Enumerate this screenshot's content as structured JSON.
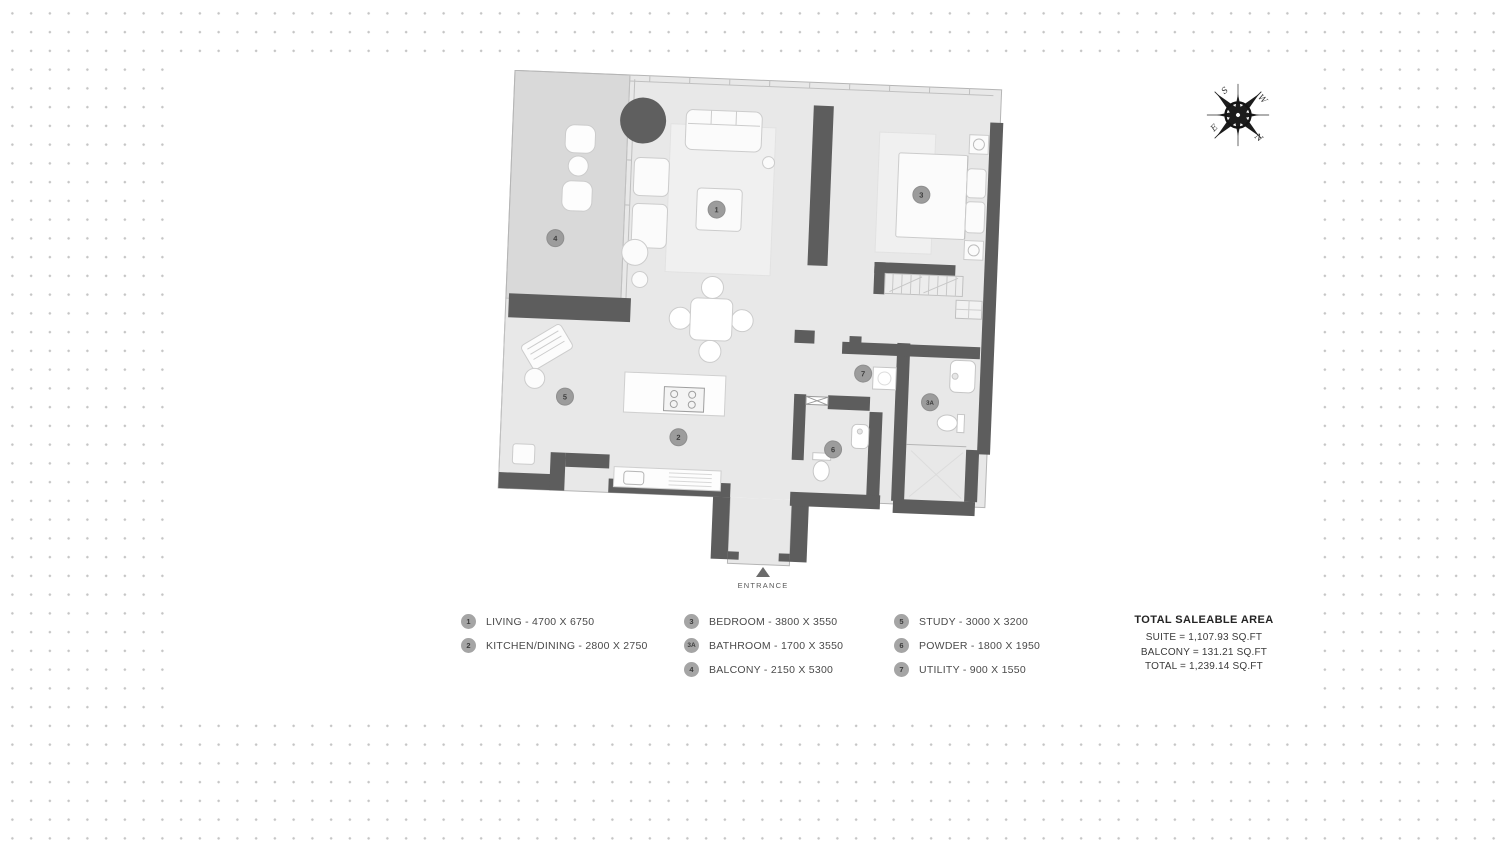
{
  "plan": {
    "entrance_label": "ENTRANCE",
    "badges": {
      "living": "1",
      "kitchen_dining": "2",
      "bedroom": "3",
      "bathroom": "3A",
      "balcony": "4",
      "study": "5",
      "powder": "6",
      "utility": "7"
    }
  },
  "compass": {
    "n": "N",
    "e": "E",
    "s": "S",
    "w": "W"
  },
  "legend": {
    "items": [
      {
        "num": "1",
        "label": "LIVING - 4700 X 6750"
      },
      {
        "num": "2",
        "label": "KITCHEN/DINING - 2800 X 2750"
      },
      {
        "num": "3",
        "label": "BEDROOM - 3800 X 3550"
      },
      {
        "num": "3A",
        "label": "BATHROOM - 1700 X 3550"
      },
      {
        "num": "4",
        "label": "BALCONY - 2150 X 5300"
      },
      {
        "num": "5",
        "label": "STUDY - 3000 X 3200"
      },
      {
        "num": "6",
        "label": "POWDER - 1800 X 1950"
      },
      {
        "num": "7",
        "label": "UTILITY - 900 X 1550"
      }
    ]
  },
  "totals": {
    "title": "TOTAL SALEABLE AREA",
    "suite": "SUITE = 1,107.93  SQ.FT",
    "balcony": "BALCONY = 131.21  SQ.FT",
    "total": "TOTAL = 1,239.14  SQ.FT"
  },
  "colors": {
    "wall": "#5d5d5d",
    "floor": "#e8e8e8",
    "balcony_floor": "#d9d9d9",
    "dot": "#c5c5c5",
    "badge_fill": "#a0a0a0"
  }
}
